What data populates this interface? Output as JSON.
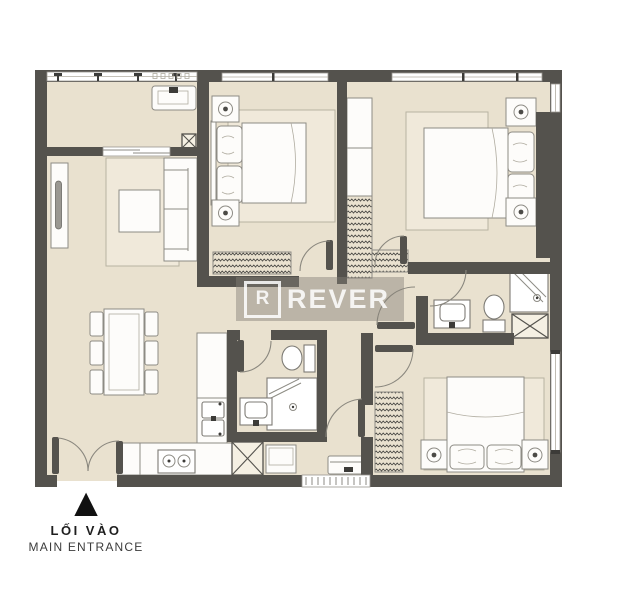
{
  "watermark": {
    "logo_letter": "R",
    "brand": "REVER"
  },
  "entrance": {
    "marker": "▲",
    "label_primary": "LỐI VÀO",
    "label_secondary": "MAIN ENTRANCE"
  },
  "colors": {
    "background": "#ffffff",
    "floor": "#e9e1cf",
    "wall": "#54524d",
    "furniture": "#fdfcfa",
    "outline": "#8d8b84",
    "rug": "#f0e9da",
    "hatch": "#4b4a46",
    "annotation": "#1e1e1e",
    "watermark_band": "rgba(130,126,117,0.45)",
    "watermark_text": "rgba(255,255,255,0.85)"
  }
}
